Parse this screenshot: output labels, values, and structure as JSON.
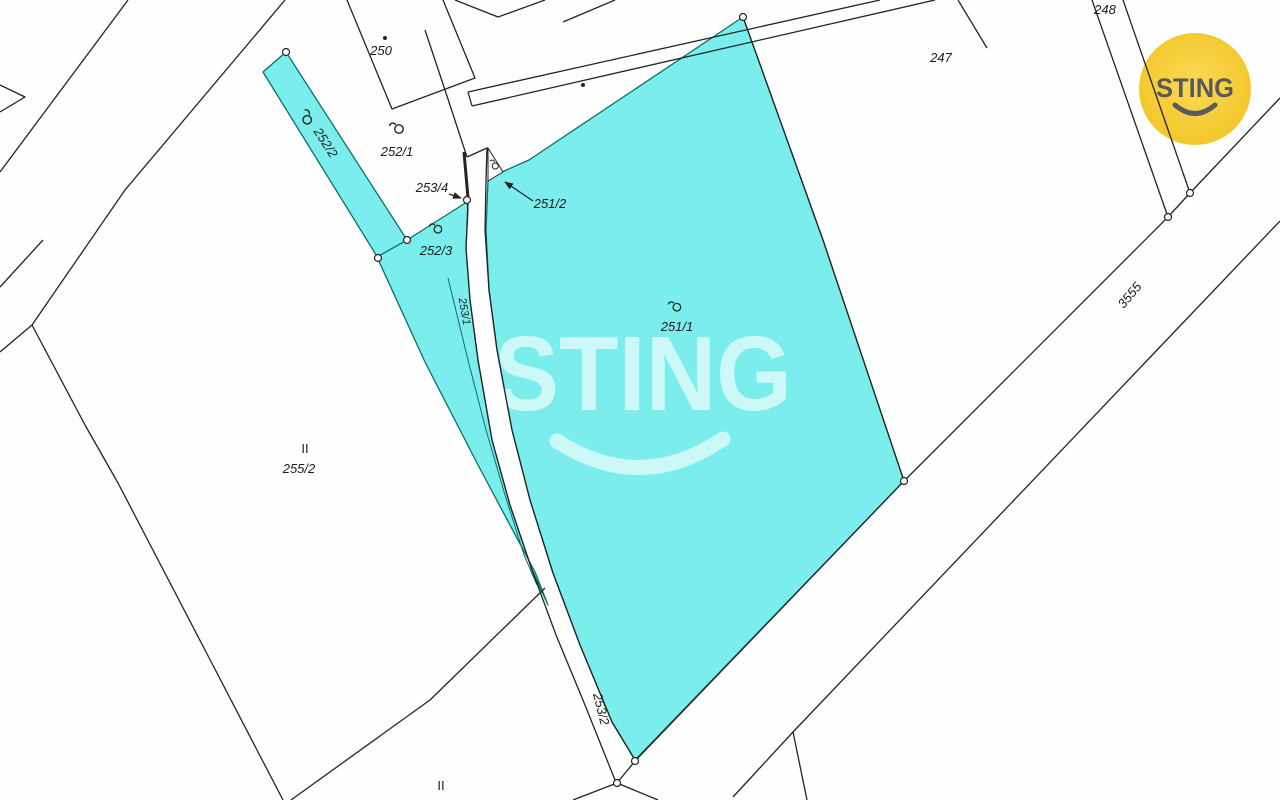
{
  "map": {
    "width": 1280,
    "height": 800,
    "background": "#fefefe",
    "line_color": "#242424",
    "highlight_fill": "#7ceded",
    "highlight_stroke": "#0d6e6e",
    "label_color": "#1b1b1b",
    "label_font_size": 13,
    "parcels_highlighted": [
      {
        "id": "252-2",
        "label": "252/2",
        "points": "286,52 263,72 378,258 407,240"
      },
      {
        "id": "252-3",
        "label": "252/3",
        "points": "407,240 467,202 468,210 466,248 470,300 478,360 492,440 510,505 532,570 548,605 535,572 478,465 425,362 377,257"
      },
      {
        "id": "251-1",
        "label": "251/1",
        "points": "743,17 529,160 502,172 488,180 486,230 489,290 497,350 512,430 530,500 553,573 580,645 612,722 635,760 904,481 823,240"
      }
    ],
    "sliver_boundary": {
      "name": "parcel-253-1-boundary",
      "d": "M448,278 L468,360 L486,430 L505,495 L524,555 L537,585"
    },
    "boundary_lines": [
      {
        "name": "path-edge-1",
        "d": "M128,0 L0,172"
      },
      {
        "name": "path-edge-2",
        "d": "M285,0 L125,190 L32,325 L0,352"
      },
      {
        "name": "path-edge-3",
        "d": "M43,240 L0,287"
      },
      {
        "name": "wedge-left",
        "d": "M0,85 L25,97 L0,112"
      },
      {
        "name": "parcel-255-2-west-boundary",
        "d": "M32,325 L85,425 L118,483 L205,650 L283,800"
      },
      {
        "name": "parcel-255-2-southeast-boundary",
        "d": "M545,588 L430,700 L291,800"
      },
      {
        "name": "building-250-outline",
        "d": "M347,0 L392,109 L475,78 L443,0"
      },
      {
        "name": "building-chevron",
        "d": "M455,0 L498,17 L545,0"
      },
      {
        "name": "building-stub",
        "d": "M563,22 L615,0"
      },
      {
        "name": "long-building-nw-edge",
        "d": "M880,0 L468,92"
      },
      {
        "name": "long-building-se-edge",
        "d": "M935,0 L472,106"
      },
      {
        "name": "long-building-end-cap",
        "d": "M472,106 L468,92"
      },
      {
        "name": "parcel-252-1-east-boundary",
        "d": "M425,30 L445,90 L467,157"
      },
      {
        "name": "strip-253-2-top",
        "d": "M467,157 L487,148"
      },
      {
        "name": "strip-253-2-left-edge",
        "d": "M468,202 L466,248 L470,300 L478,360 L492,440 L510,505 L532,570 L556,635 L585,705 L615,780"
      },
      {
        "name": "strip-253-2-right-edge",
        "d": "M487,148 L486,180 L485,230 L489,290 L497,350 L512,430 L530,500 L553,573 L580,645 L612,722 L635,760"
      },
      {
        "name": "strip-253-2-bottom",
        "d": "M635,761 L617,783"
      },
      {
        "name": "strip-continuation-left",
        "d": "M617,783 L573,800"
      },
      {
        "name": "strip-continuation-right",
        "d": "M617,783 L658,800"
      },
      {
        "name": "road-3555-nw-edge",
        "d": "M1280,98 L1190,193 L1168,217 L904,481"
      },
      {
        "name": "parcel-251-1-south-edge",
        "d": "M904,481 L635,761"
      },
      {
        "name": "parcel-251-1-northeast-edge",
        "d": "M743,17 L823,240 L904,481"
      },
      {
        "name": "road-3555-se-edge",
        "d": "M1280,221 L793,732"
      },
      {
        "name": "road-3555-se-branch-left",
        "d": "M793,732 L733,797"
      },
      {
        "name": "road-3555-se-branch-right",
        "d": "M793,732 L807,800"
      },
      {
        "name": "parcel-248-west-edge",
        "d": "M1092,0 L1168,217"
      },
      {
        "name": "parcel-248-east-edge",
        "d": "M1123,0 L1190,193"
      },
      {
        "name": "parcel-247-stub",
        "d": "M958,0 L987,48"
      }
    ],
    "thick_segment": {
      "name": "parcel-253-4-sliver",
      "d": "M464,152 L468,198",
      "width": 3
    },
    "small_white_parcels": [
      {
        "name": "parcel-251-2-triangle",
        "points": "488,148 503,172 488,181"
      }
    ],
    "vertex_markers": [
      [
        286,
        52
      ],
      [
        378,
        258
      ],
      [
        407,
        240
      ],
      [
        467,
        200
      ],
      [
        743,
        17
      ],
      [
        904,
        481
      ],
      [
        1168,
        217
      ],
      [
        1190,
        193
      ],
      [
        635,
        761
      ],
      [
        617,
        783
      ]
    ],
    "survey_dots": [
      [
        385,
        38
      ],
      [
        583,
        85
      ]
    ],
    "landuse_symbols": [
      {
        "x": 398,
        "y": 131,
        "rot": 0,
        "scale": 1
      },
      {
        "x": 305,
        "y": 120,
        "rot": 57,
        "scale": 1
      },
      {
        "x": 437,
        "y": 231,
        "rot": 0,
        "scale": 0.9
      },
      {
        "x": 676,
        "y": 309,
        "rot": 0,
        "scale": 0.9
      },
      {
        "x": 494,
        "y": 167,
        "rot": 25,
        "scale": 0.72
      }
    ],
    "leader_arrows": [
      {
        "name": "arrow-to-253-4",
        "x1": 449,
        "y1": 194,
        "x2": 461,
        "y2": 198
      },
      {
        "name": "arrow-to-251-2",
        "x1": 533,
        "y1": 201,
        "x2": 505,
        "y2": 182
      }
    ],
    "labels": [
      {
        "name": "parcel-label-250",
        "text": "250",
        "x": 381,
        "y": 55
      },
      {
        "name": "parcel-label-252-1",
        "text": "252/1",
        "x": 397,
        "y": 156
      },
      {
        "name": "parcel-label-253-4",
        "text": "253/4",
        "x": 432,
        "y": 192
      },
      {
        "name": "parcel-label-251-2",
        "text": "251/2",
        "x": 550,
        "y": 208
      },
      {
        "name": "parcel-label-252-3",
        "text": "252/3",
        "x": 436,
        "y": 255
      },
      {
        "name": "parcel-label-251-1",
        "text": "251/1",
        "x": 677,
        "y": 331
      },
      {
        "name": "parcel-label-247",
        "text": "247",
        "x": 941,
        "y": 62
      },
      {
        "name": "parcel-label-248",
        "text": "248",
        "x": 1105,
        "y": 14
      },
      {
        "name": "landuse-mark-255-2",
        "text": "II",
        "x": 305,
        "y": 453,
        "upright": true
      },
      {
        "name": "parcel-label-255-2",
        "text": "255/2",
        "x": 299,
        "y": 473
      },
      {
        "name": "landuse-mark-bottom",
        "text": "II",
        "x": 441,
        "y": 790,
        "upright": true
      },
      {
        "name": "parcel-label-252-2",
        "text": "252/2",
        "x": 322,
        "y": 145,
        "rot": 57
      },
      {
        "name": "parcel-label-253-1",
        "text": "253/1",
        "x": 461,
        "y": 312,
        "rot": 80,
        "size": 11
      },
      {
        "name": "parcel-label-253-2",
        "text": "253/2",
        "x": 597,
        "y": 710,
        "rot": 76
      },
      {
        "name": "road-label-3555",
        "text": "3555",
        "x": 1133,
        "y": 298,
        "rot": -50
      }
    ],
    "watermark": {
      "text": "STING",
      "x": 643,
      "y": 410,
      "font_size": 106,
      "text_length": 298,
      "color": "rgba(255,255,255,0.62)",
      "smile_d": "M557,441 Q640,495 723,439",
      "smile_width": 15
    },
    "logo": {
      "text": "STING",
      "cx": 1195,
      "cy": 89,
      "r": 56,
      "fill_center": "#fbd955",
      "fill_edge": "#f2c526",
      "text_color": "#595a5c",
      "font_size": 27,
      "text_length": 78,
      "text_y": 97,
      "smile_d": "M1175,105 Q1195,122 1215,105",
      "smile_width": 5
    }
  }
}
